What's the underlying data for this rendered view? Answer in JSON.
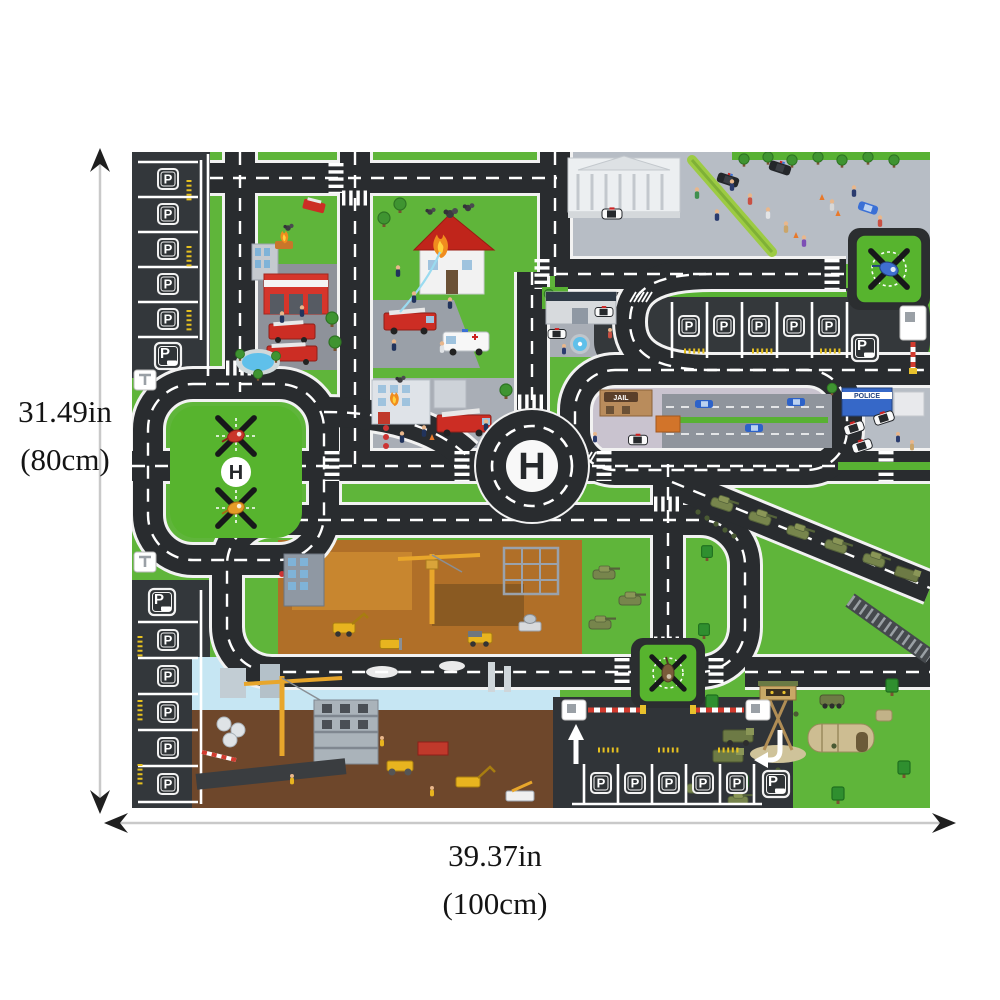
{
  "page": {
    "background": "#ffffff"
  },
  "dimensions": {
    "height": {
      "value": "31.49in",
      "metric": "(80cm)"
    },
    "width": {
      "value": "39.37in",
      "metric": "(100cm)"
    }
  },
  "mat": {
    "parking_letter": "P",
    "helipad_letter": "H",
    "jail_label": "JAIL",
    "police_label": "POLICE",
    "colors": {
      "grass": "#5fb53a",
      "road": "#292c2f",
      "road_marking": "#ffffff",
      "pavement_light": "#b7bdc5",
      "pavement_mid": "#a9aeb6",
      "pavement_jail": "#c9c3cf",
      "parking_dark": "#33373b",
      "helipad_green": "#57b42e",
      "fire_red": "#d6352b",
      "roof_red": "#c0251b",
      "ambulance_white": "#f7f7f7",
      "police_blue": "#3668c8",
      "construction_dirt": "#b06f28",
      "deep_dirt": "#6e472b",
      "sky": "#c6e6f3",
      "military_tan": "#cdbd92",
      "tank_green": "#77854c",
      "chevron_yellow": "#e7c11f",
      "dimension_text": "#141414",
      "arrow_line": "#c9c9c9"
    }
  }
}
